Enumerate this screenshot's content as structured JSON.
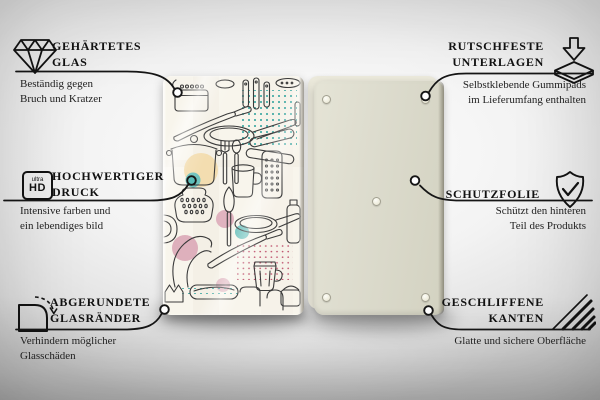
{
  "features": {
    "left": [
      {
        "icon": "diamond-icon",
        "title_lines": [
          "GEHÄRTETES",
          "GLAS"
        ],
        "subtitle_lines": [
          "Beständig gegen",
          "Bruch und Kratzer"
        ]
      },
      {
        "icon": "ultra-hd-icon",
        "icon_text_small": "ultra",
        "icon_text_big": "HD",
        "title_lines": [
          "HOCHWERTIGER",
          "DRUCK"
        ],
        "subtitle_lines": [
          "Intensive farben und",
          "ein lebendiges bild"
        ]
      },
      {
        "icon": "rounded-corner-icon",
        "title_lines": [
          "ABGERUNDETE",
          "GLASRÄNDER"
        ],
        "subtitle_lines": [
          "Verhindern möglicher",
          "Glasschäden"
        ]
      }
    ],
    "right": [
      {
        "icon": "anti-slip-pads-icon",
        "title_lines": [
          "RUTSCHFESTE",
          "UNTERLAGEN"
        ],
        "subtitle_lines": [
          "Selbstklebende Gummipads",
          "im Lieferumfang enthalten"
        ]
      },
      {
        "icon": "shield-check-icon",
        "title_lines": [
          "SCHUTZFOLIE"
        ],
        "subtitle_lines": [
          "Schützt den hinteren",
          "Teil des Produkts"
        ]
      },
      {
        "icon": "polished-edges-icon",
        "title_lines": [
          "GESCHLIFFENE",
          "KANTEN"
        ],
        "subtitle_lines": [
          "Glatte und sichere Oberfläche"
        ]
      }
    ]
  },
  "product": {
    "front_panel": "glass-board-front-kitchen-utensils-pattern",
    "back_panel": "board-back-with-rubber-pads"
  },
  "colors": {
    "line": "#161616",
    "accent_teal": "#5bbcb8",
    "accent_pink": "#d9a3b4",
    "accent_tan": "#f3ddb0",
    "accent_red_dots": "#c05570",
    "board_front": "#f8f5ec",
    "board_back": "#dddcce"
  }
}
